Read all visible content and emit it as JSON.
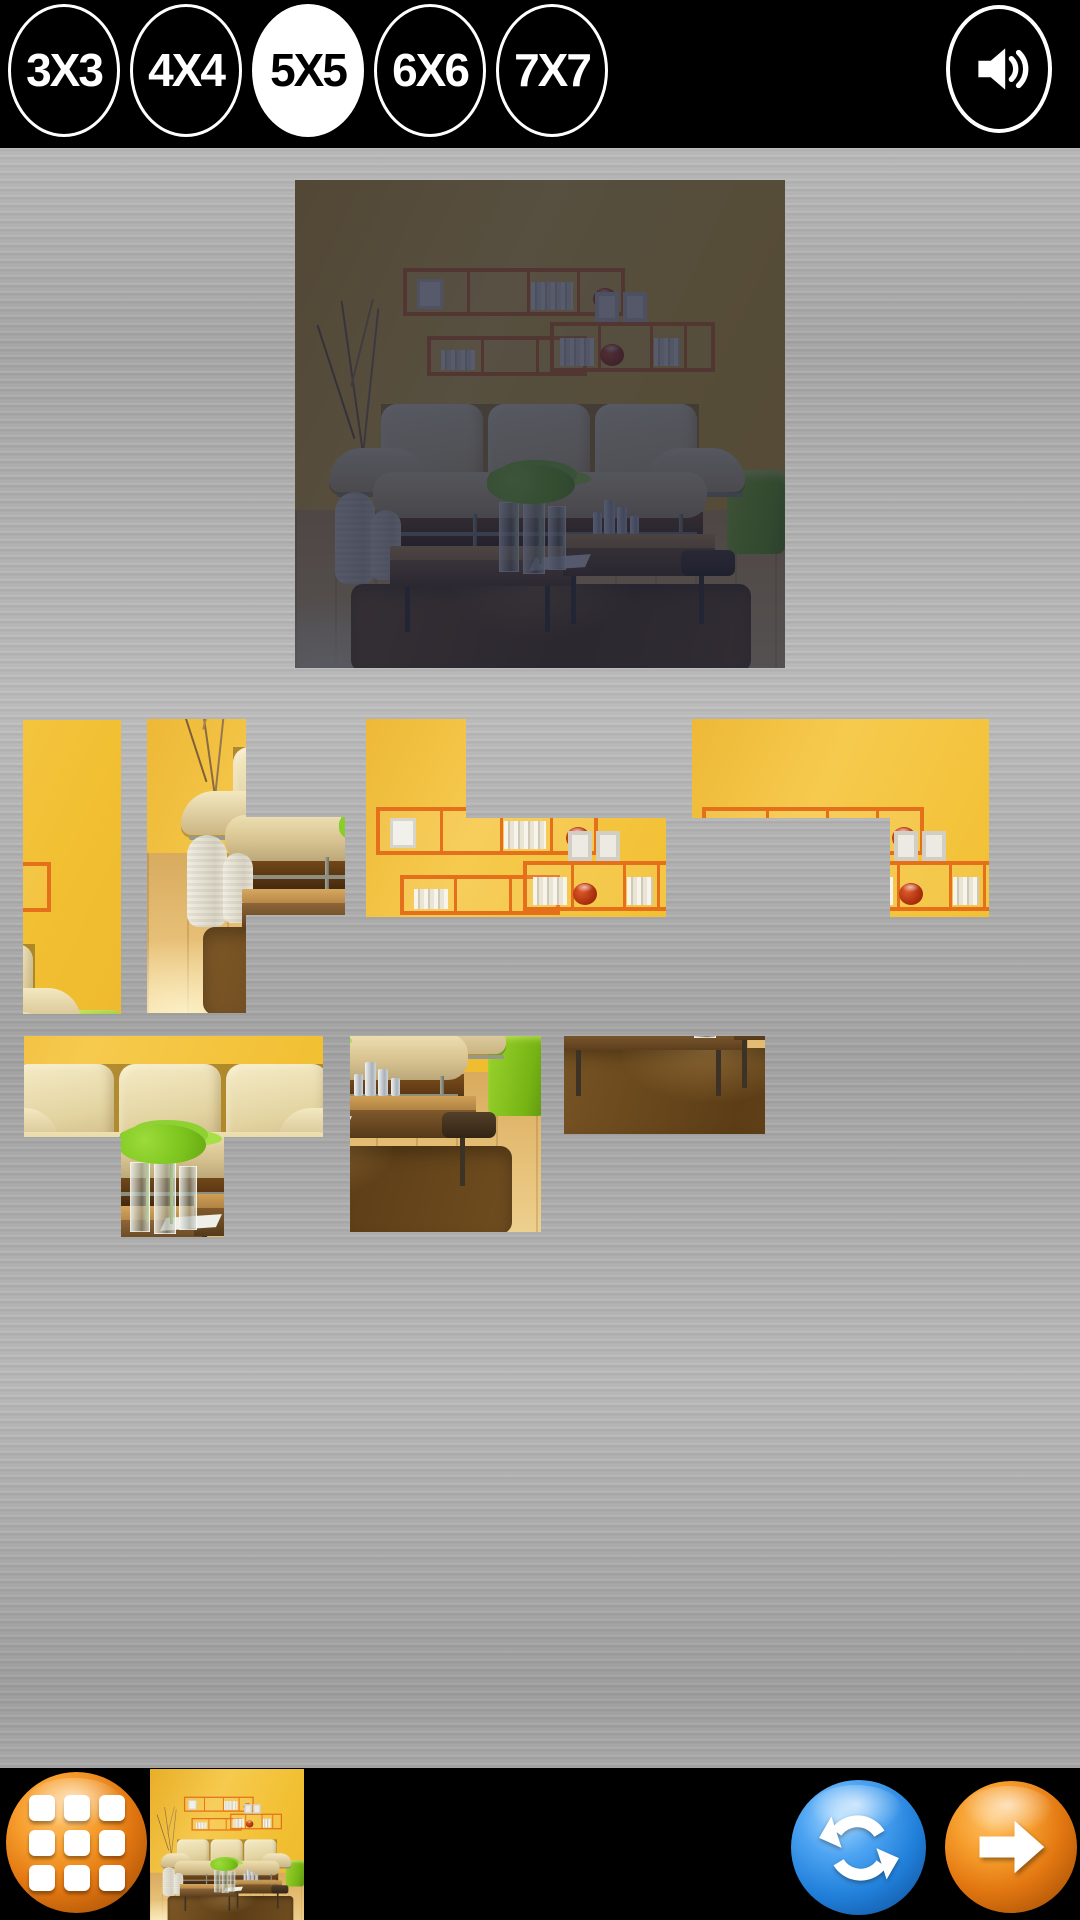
{
  "top_bar": {
    "grid_size_buttons": [
      {
        "label": "3X3",
        "selected": false
      },
      {
        "label": "4X4",
        "selected": false
      },
      {
        "label": "5X5",
        "selected": true
      },
      {
        "label": "6X6",
        "selected": false
      },
      {
        "label": "7X7",
        "selected": false
      }
    ],
    "selected_grid_size": "5X5",
    "sound_icon": "speaker-on-icon"
  },
  "puzzle": {
    "rows": 5,
    "cols": 5,
    "image_subject": "yellow living room with orange shelves, cream sofa and wooden coffee tables",
    "preview_dimmed": true,
    "pieces": [
      {
        "id": "puzzle-piece-a",
        "x": 23,
        "y": 720,
        "w": 98,
        "h": 294,
        "clip": null,
        "scene_x": 392,
        "scene_y": 0
      },
      {
        "id": "puzzle-piece-b",
        "x": 147,
        "y": 719,
        "w": 198,
        "h": 294,
        "clip": [
          [
            0,
            0
          ],
          [
            99,
            0
          ],
          [
            99,
            98
          ],
          [
            198,
            98
          ],
          [
            198,
            196
          ],
          [
            99,
            196
          ],
          [
            99,
            294
          ],
          [
            0,
            294
          ]
        ],
        "scene_x": 0,
        "scene_y": 196
      },
      {
        "id": "puzzle-piece-c",
        "x": 366,
        "y": 719,
        "w": 300,
        "h": 198,
        "clip": [
          [
            0,
            0
          ],
          [
            100,
            0
          ],
          [
            100,
            99
          ],
          [
            300,
            99
          ],
          [
            300,
            198
          ],
          [
            0,
            198
          ]
        ],
        "scene_x": 98,
        "scene_y": 0
      },
      {
        "id": "puzzle-piece-d",
        "x": 692,
        "y": 719,
        "w": 297,
        "h": 198,
        "clip": [
          [
            0,
            0
          ],
          [
            297,
            0
          ],
          [
            297,
            198
          ],
          [
            198,
            198
          ],
          [
            198,
            99
          ],
          [
            0,
            99
          ]
        ],
        "scene_x": 98,
        "scene_y": 0
      },
      {
        "id": "puzzle-piece-e",
        "x": 24,
        "y": 1036,
        "w": 299,
        "h": 201,
        "clip": [
          [
            0,
            0
          ],
          [
            299,
            0
          ],
          [
            299,
            101
          ],
          [
            200,
            101
          ],
          [
            200,
            201
          ],
          [
            97,
            201
          ],
          [
            97,
            101
          ],
          [
            0,
            101
          ]
        ],
        "scene_x": 98,
        "scene_y": 196
      },
      {
        "id": "puzzle-piece-f",
        "x": 350,
        "y": 1036,
        "w": 191,
        "h": 199,
        "clip": null,
        "scene_x": 294,
        "scene_y": 294
      },
      {
        "id": "puzzle-piece-g",
        "x": 564,
        "y": 1036,
        "w": 201,
        "h": 99,
        "clip": null,
        "scene_x": 98,
        "scene_y": 392
      }
    ]
  },
  "bottom_bar": {
    "menu_icon": "grid-menu-icon",
    "thumbnail": "puzzle-image-thumbnail",
    "shuffle_icon": "refresh-icon",
    "next_icon": "arrow-right-icon"
  },
  "colors": {
    "bar_black": "#000000",
    "selected_white": "#ffffff",
    "metal_gray": "#ababab",
    "wall_yellow": "#f2c033",
    "shelf_orange": "#e4701c",
    "cube_green": "#76b414",
    "rug_brown": "#6f4d20",
    "btn_orange": "#e27711",
    "btn_blue": "#2180da"
  }
}
